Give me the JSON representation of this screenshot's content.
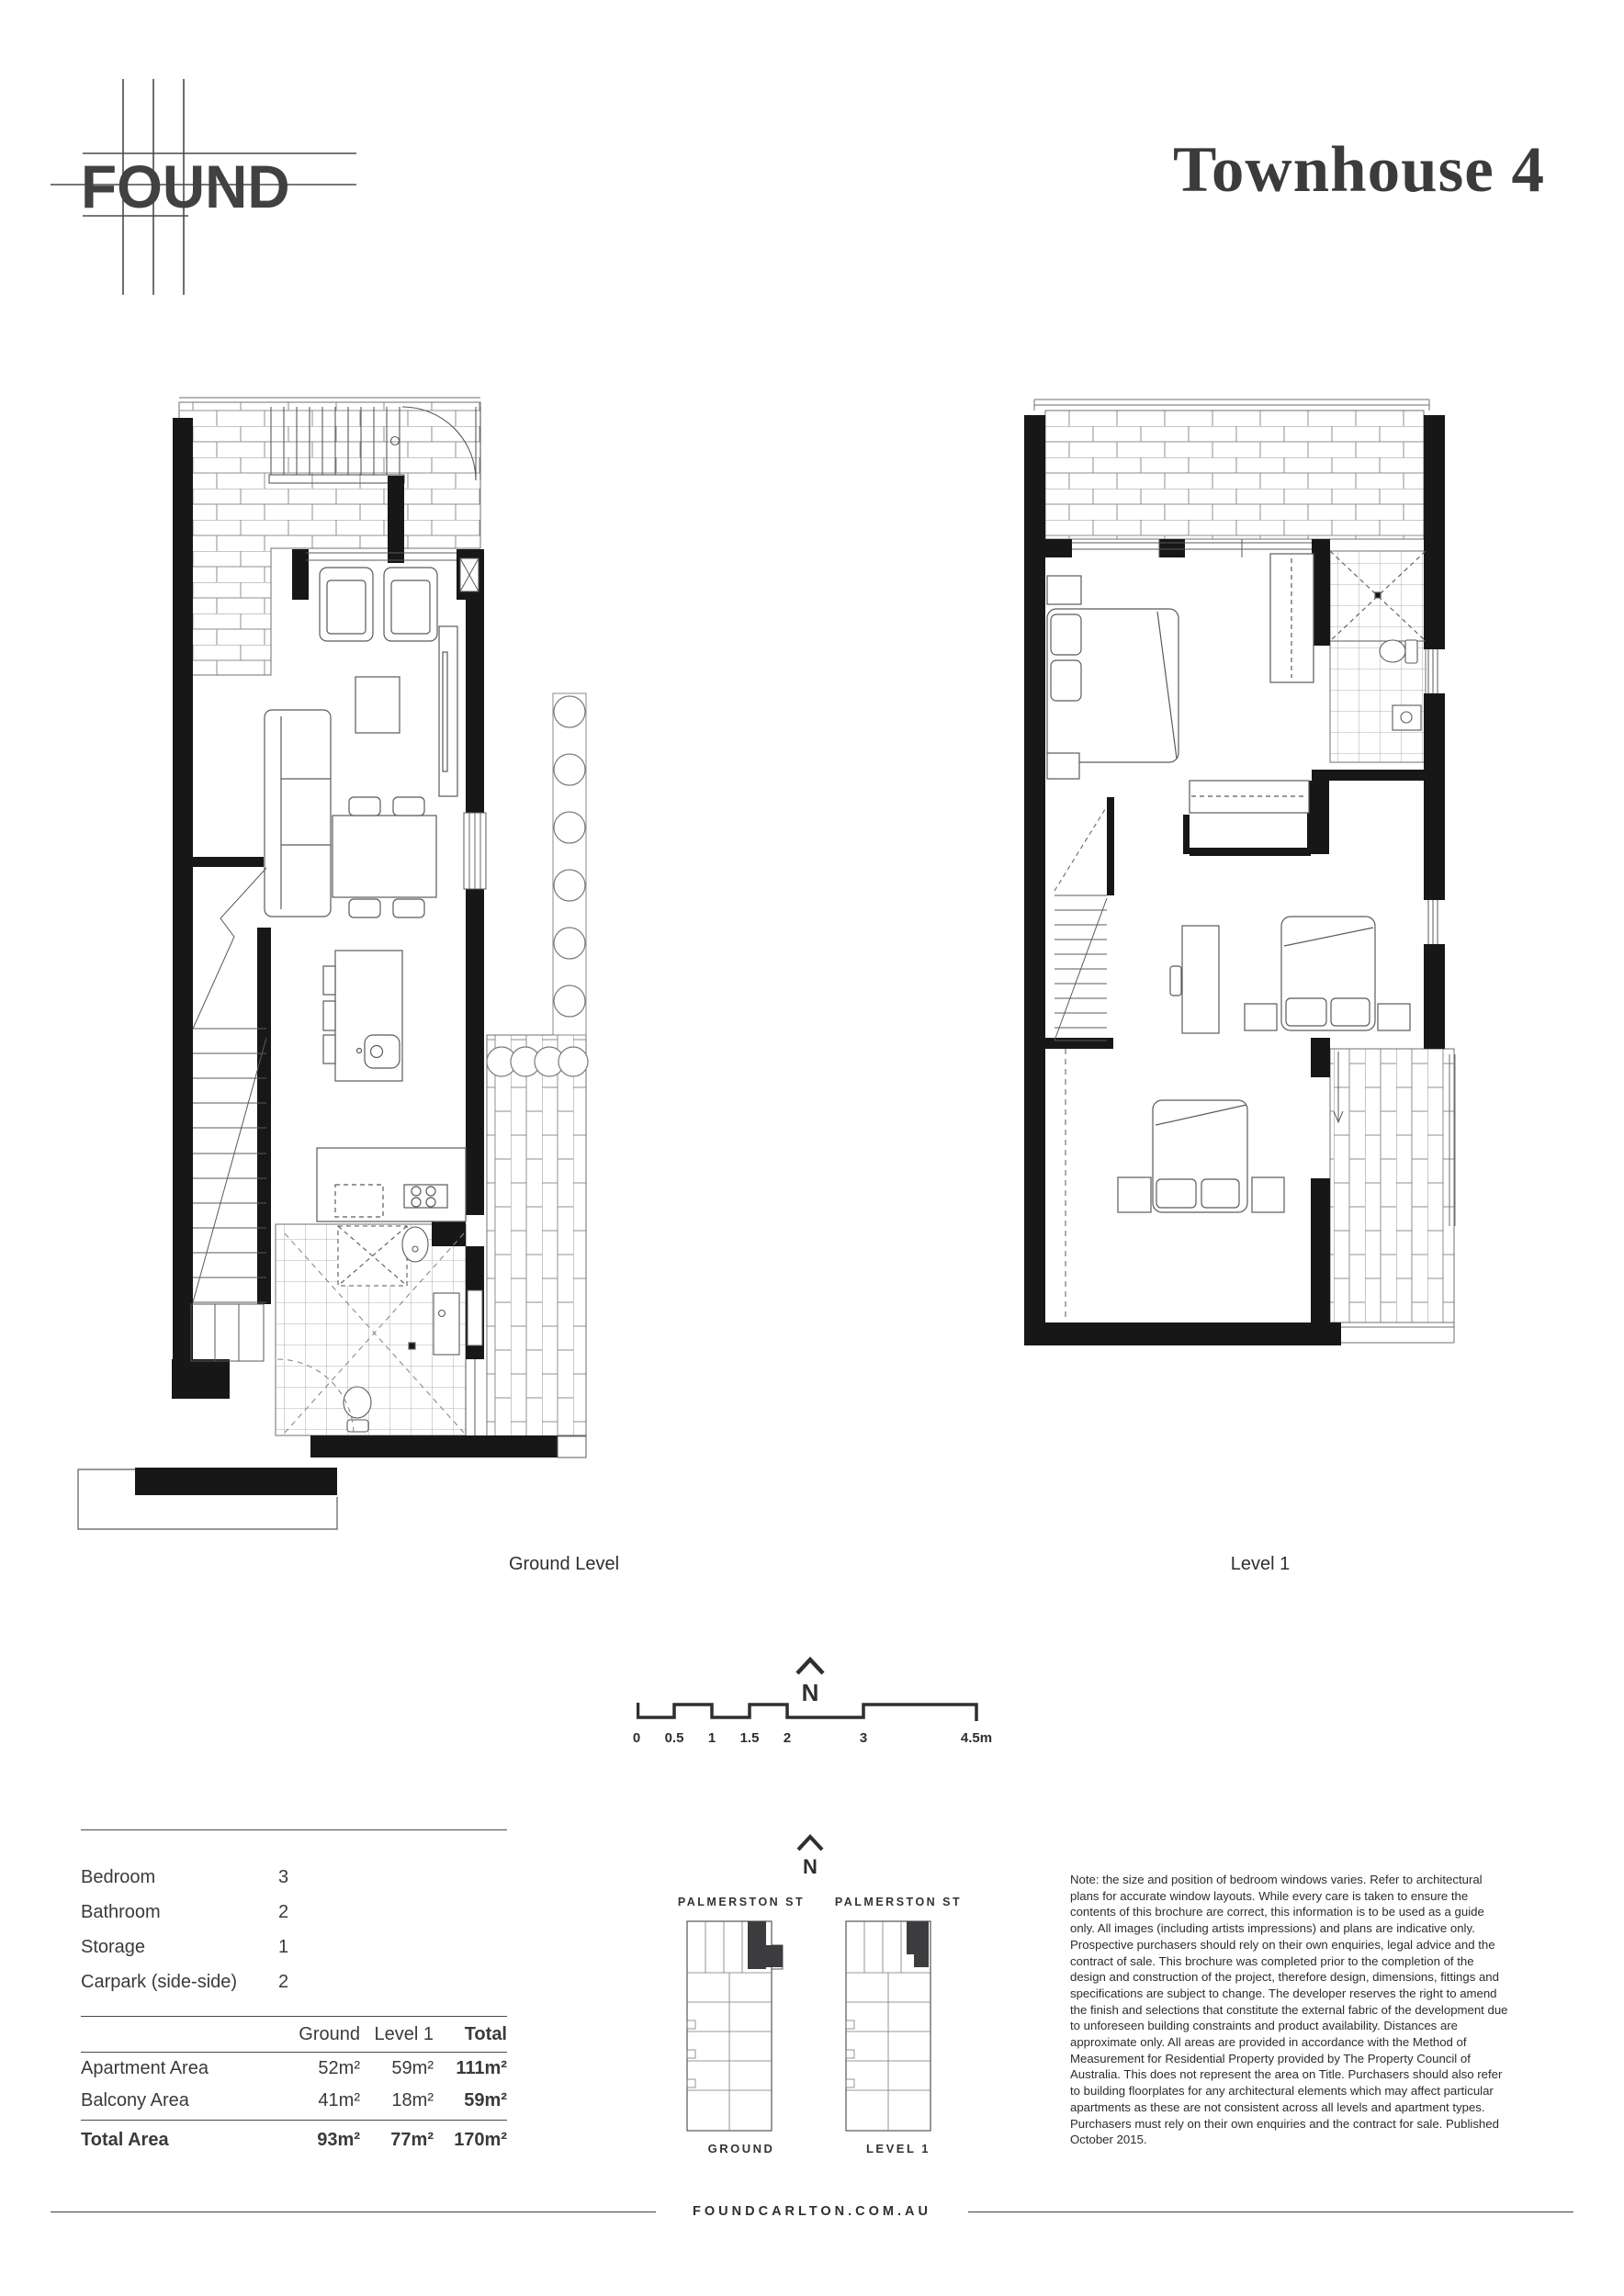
{
  "brand": {
    "logo": "FOUND"
  },
  "title": "Townhouse 4",
  "plans": {
    "ground_label": "Ground Level",
    "level1_label": "Level 1"
  },
  "compass": {
    "north": "N"
  },
  "scale_bar": {
    "ticks": [
      "0",
      "0.5",
      "1",
      "1.5",
      "2",
      "3",
      "4.5m"
    ]
  },
  "summary": {
    "features": [
      {
        "label": "Bedroom",
        "value": "3"
      },
      {
        "label": "Bathroom",
        "value": "2"
      },
      {
        "label": "Storage",
        "value": "1"
      },
      {
        "label": "Carpark (side-side)",
        "value": "2"
      }
    ]
  },
  "areas": {
    "columns": [
      "Ground",
      "Level 1",
      "Total"
    ],
    "rows": [
      {
        "label": "Apartment Area",
        "values": [
          "52m²",
          "59m²",
          "111m²"
        ]
      },
      {
        "label": "Balcony Area",
        "values": [
          "41m²",
          "18m²",
          "59m²"
        ]
      }
    ],
    "total": {
      "label": "Total Area",
      "values": [
        "93m²",
        "77m²",
        "170m²"
      ]
    }
  },
  "key_plans": {
    "left": {
      "street": "PALMERSTON ST",
      "caption": "GROUND"
    },
    "right": {
      "street": "PALMERSTON ST",
      "caption": "LEVEL 1"
    }
  },
  "note": {
    "text": "Note: the size and position of bedroom windows varies. Refer to architectural plans for accurate window layouts. While every care is taken to ensure the contents of this brochure are correct, this information is to be used as a guide only. All images (including artists impressions) and plans are indicative only. Prospective purchasers should rely on their own enquiries, legal advice and the contract of sale. This brochure was completed prior to the completion of the design and construction of the project, therefore design, dimensions, fittings and specifications are subject to change. The developer reserves the right to amend the finish and selections that constitute the external fabric of the development due to unforeseen building constraints and product availability. Distances are approximate only. All areas are provided in accordance with the Method of Measurement for Residential Property provided by The Property Council of Australia. This does not represent the area on Title. Purchasers should also refer to building floorplates for any architectural elements which may affect particular apartments as these are not consistent across all levels and apartment types. Purchasers must rely on their own enquiries and the contract for sale. Published October 2015."
  },
  "footer": {
    "url": "FOUNDCARLTON.COM.AU"
  },
  "colors": {
    "ink": "#3a3a3c",
    "wall": "#171717",
    "plan_line": "#5a5a5a",
    "brick_line": "#8f8f8f"
  }
}
